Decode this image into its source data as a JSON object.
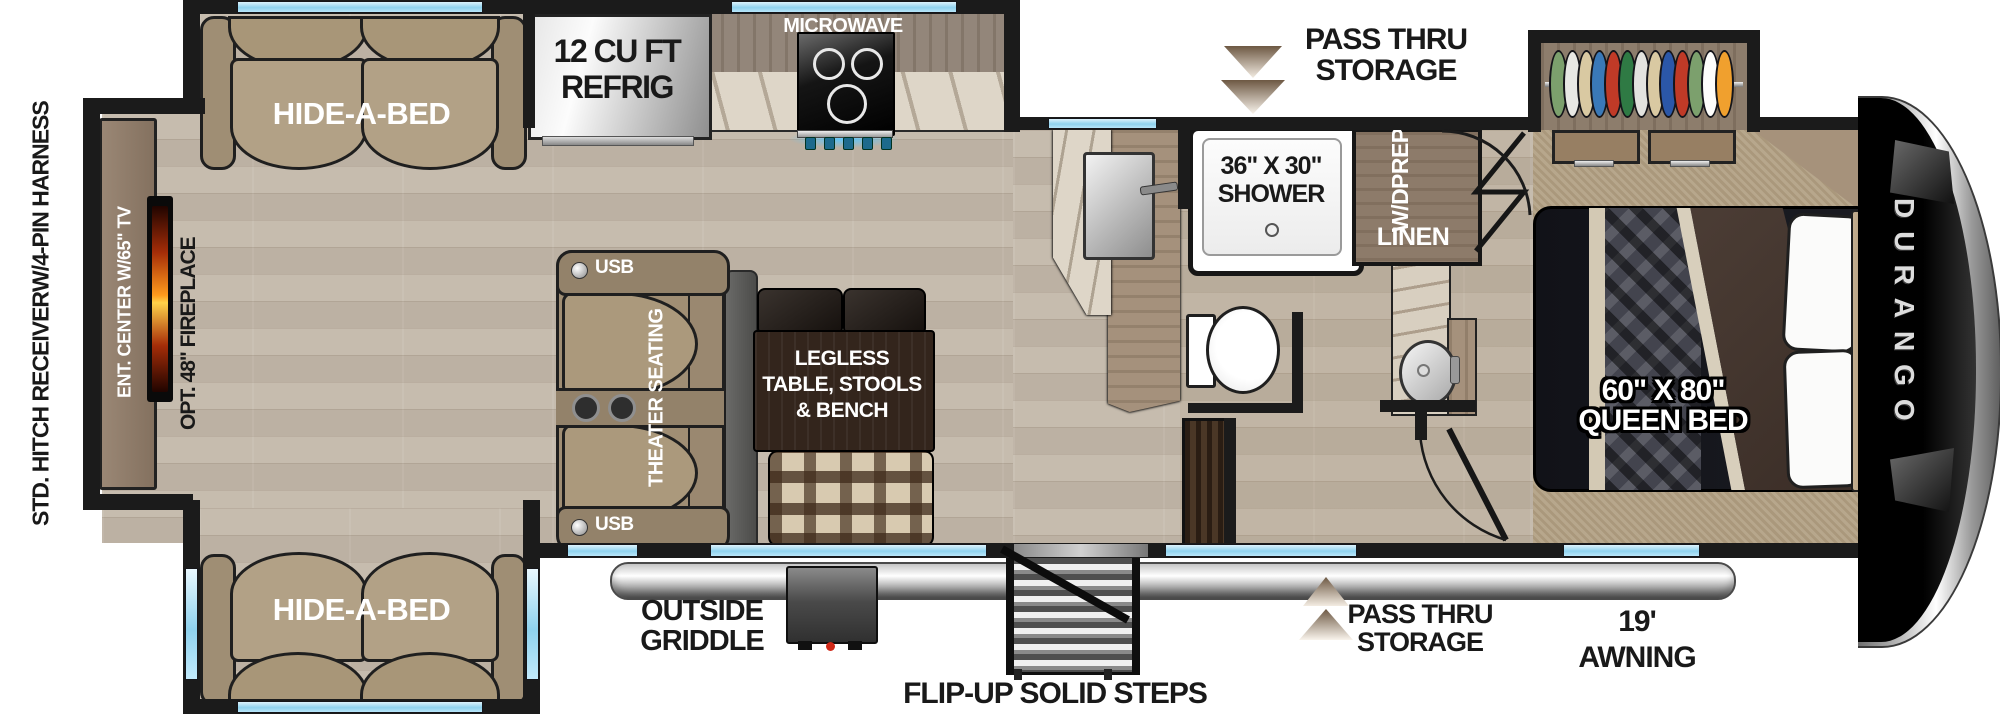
{
  "title": "Durango fifth wheel RV floor plan",
  "labels": {
    "hitch1": "STD. HITCH RECEIVER",
    "hitch2": "W/4-PIN HARNESS",
    "ent_center": "ENT. CENTER W/65\" TV",
    "fireplace": "OPT. 48\" FIREPLACE",
    "hide_a_bed_top": "HIDE-A-BED",
    "hide_a_bed_bottom": "HIDE-A-BED",
    "refrig1": "12 CU FT",
    "refrig2": "REFRIG",
    "microwave": "MICROWAVE",
    "pass_thru_top1": "PASS THRU",
    "pass_thru_top2": "STORAGE",
    "shower1": "36\" X 30\"",
    "shower2": "SHOWER",
    "wd1": "W/D",
    "wd2": "PREP",
    "linen": "LINEN",
    "usb_top": "USB",
    "usb_bottom": "USB",
    "theater": "THEATER SEATING",
    "dinette1": "LEGLESS",
    "dinette2": "TABLE, STOOLS",
    "dinette3": "& BENCH",
    "bed1": "60\" X 80\"",
    "bed2": "QUEEN BED",
    "griddle1": "OUTSIDE",
    "griddle2": "GRIDDLE",
    "steps": "FLIP-UP SOLID STEPS",
    "pass_thru_bottom1": "PASS THRU",
    "pass_thru_bottom2": "STORAGE",
    "awning1": "19'",
    "awning2": "AWNING",
    "brand": "DURANGO"
  },
  "colors": {
    "wall": "#1b1b1b",
    "window_glass": "#8fd2ee",
    "wood_floor": "#c2b7a9",
    "carpet": "#b2a083",
    "sofa_tan": "#a5937a",
    "cabinet_wood": "#8d7b6a",
    "counter_marble": "#ded6c8",
    "fireplace_glow": "#ff9a1f",
    "stainless": "#cfcfcf",
    "bed_comforter": "#17181d",
    "bed_blanket": "#463831",
    "plaid_bench_base": "#d8cab0",
    "awning_silver": "#c7c7c7"
  },
  "closet": {
    "clothes_colors": [
      "#7ca06d",
      "#e8e8e4",
      "#d9c9a2",
      "#3a79b8",
      "#c03a27",
      "#2f7a44",
      "#e3e3df",
      "#d9c9a2",
      "#2b57a8",
      "#c03a27",
      "#7ca06d",
      "#fdfdfb",
      "#f0a02e"
    ]
  }
}
